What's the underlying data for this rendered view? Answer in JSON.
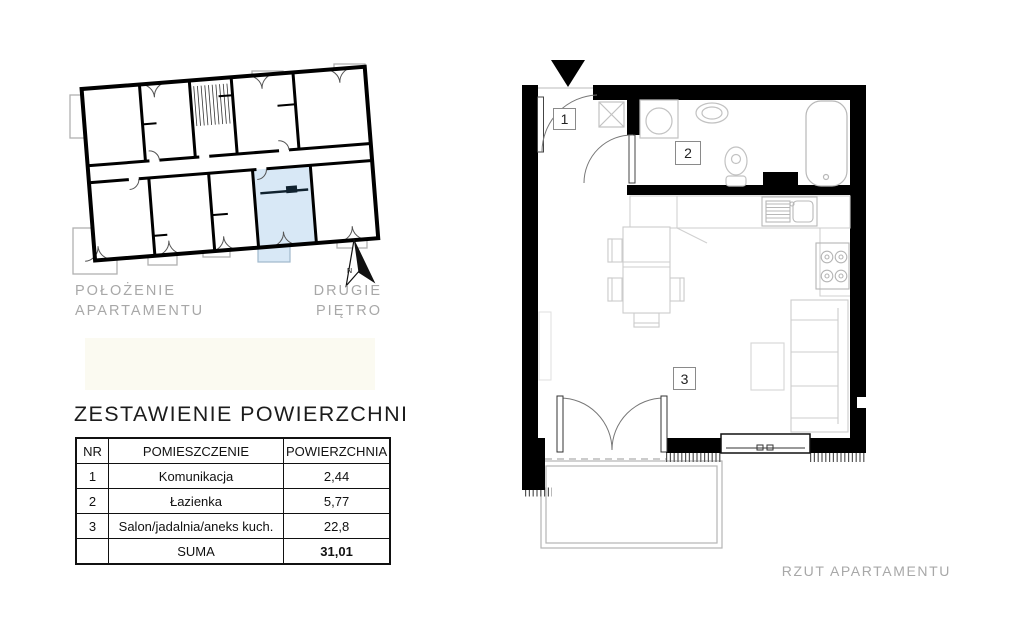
{
  "document": {
    "location_plan": {
      "label_line1": "POŁOŻENIE",
      "label_line2": "APARTAMENTU",
      "floor_line1": "DRUGIE",
      "floor_line2": "PIĘTRO",
      "north_letter": "N"
    },
    "area_table": {
      "title": "ZESTAWIENIE POWIERZCHNI",
      "headers": {
        "nr": "NR",
        "room": "POMIESZCZENIE",
        "area": "POWIERZCHNIA"
      },
      "rows": [
        {
          "nr": "1",
          "room": "Komunikacja",
          "area": "2,44"
        },
        {
          "nr": "2",
          "room": "Łazienka",
          "area": "5,77"
        },
        {
          "nr": "3",
          "room": "Salon/jadalnia/aneks kuch.",
          "area": "22,8"
        }
      ],
      "total": {
        "label": "SUMA",
        "value": "31,01"
      }
    },
    "apartment_plan": {
      "caption": "RZUT APARTAMENTU",
      "room_labels": [
        "1",
        "2",
        "3"
      ]
    },
    "colors": {
      "wall": "#000000",
      "highlight": "#d8e8f6",
      "muted_text": "#a8a8a8",
      "furniture_line": "#c9c9c9"
    }
  }
}
